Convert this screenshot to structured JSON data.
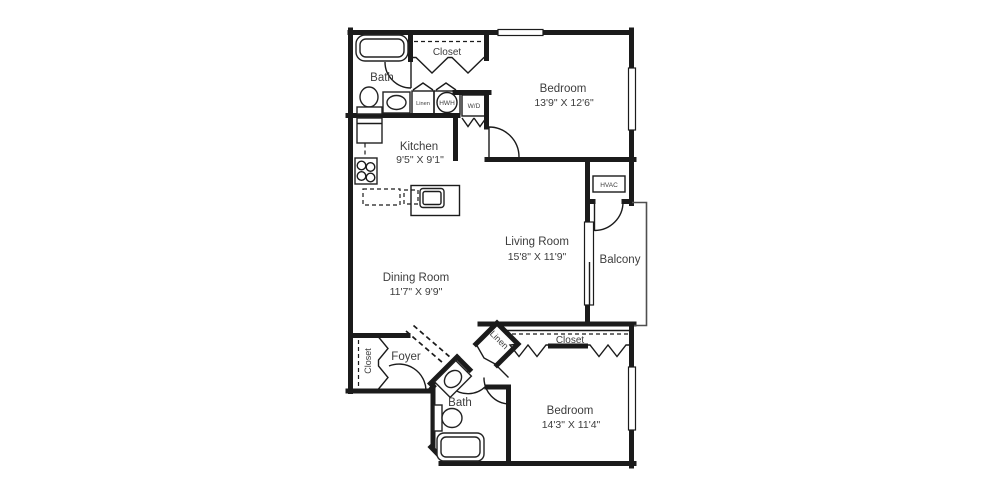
{
  "floor_plan": {
    "colors": {
      "wall": "#1b1b1b",
      "fixture": "#222222",
      "text": "#3d3d3d",
      "background": "#ffffff"
    },
    "rooms": {
      "bath1": {
        "label": "Bath"
      },
      "closet1": {
        "label": "Closet"
      },
      "bedroom1": {
        "label": "Bedroom",
        "dims": "13'9\" X 12'6\""
      },
      "linen1": {
        "label": "Linen"
      },
      "hwh": {
        "label": "HWH"
      },
      "wd": {
        "label": "W/D"
      },
      "kitchen": {
        "label": "Kitchen",
        "dims": "9'5\" X 9'1\""
      },
      "hvac": {
        "label": "HVAC"
      },
      "living": {
        "label": "Living Room",
        "dims": "15'8\" X 11'9\""
      },
      "balcony": {
        "label": "Balcony"
      },
      "dining": {
        "label": "Dining Room",
        "dims": "11'7\" X 9'9\""
      },
      "foyer": {
        "label": "Foyer"
      },
      "closet2": {
        "label": "Closet"
      },
      "linen2": {
        "label": "Linen"
      },
      "closet3": {
        "label": "Closet"
      },
      "bath2": {
        "label": "Bath"
      },
      "bedroom2": {
        "label": "Bedroom",
        "dims": "14'3\" X 11'4\""
      }
    }
  }
}
